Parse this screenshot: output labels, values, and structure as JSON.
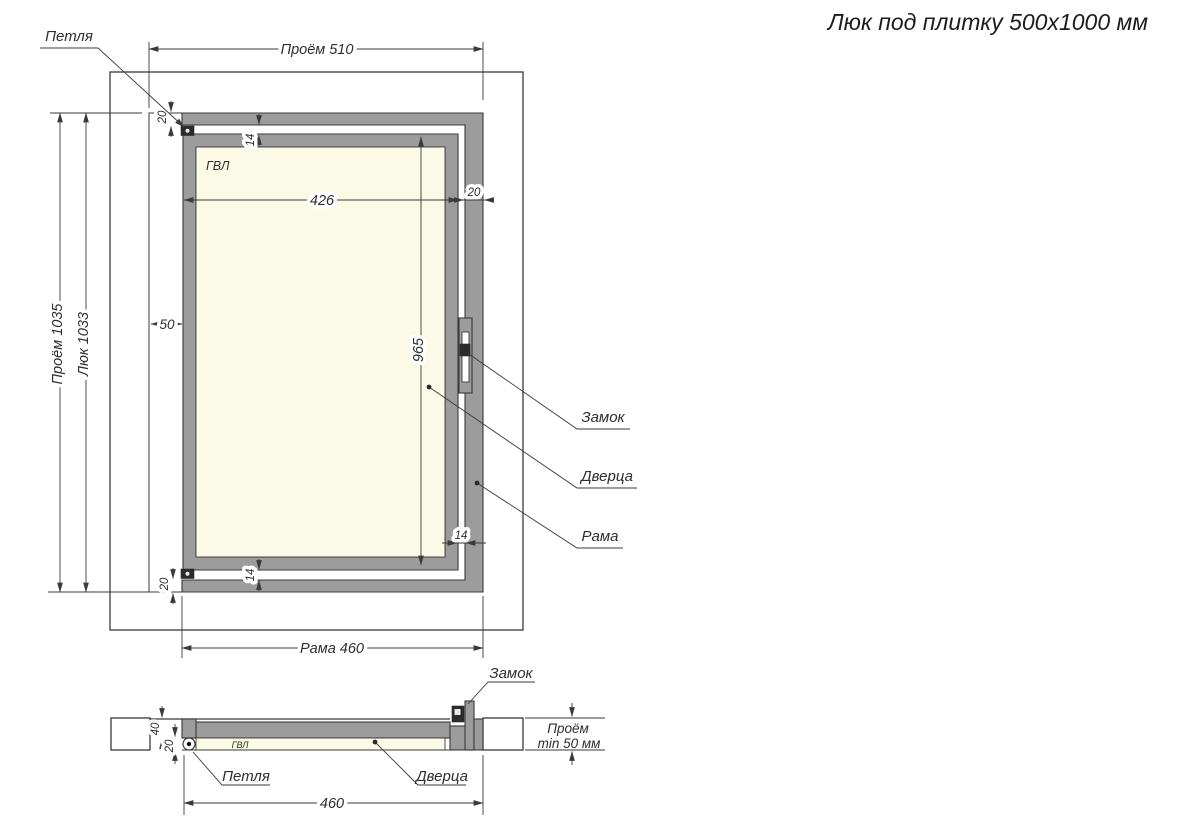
{
  "title": "Люк под плитку 500x1000 мм",
  "colors": {
    "frame_gray": "#9c9c9c",
    "panel_fill": "#fafae6",
    "line": "#3a3a3a"
  },
  "front_view": {
    "dims": {
      "opening_width": "Проём 510",
      "opening_height": "Проём 1035",
      "hatch_height": "Люк 1033",
      "frame_width": "Рама 460",
      "door_width": "426",
      "door_height": "965",
      "side_gap": "50",
      "frame_profile_top_left": "20",
      "frame_profile_right": "20",
      "frame_profile_bottom_left": "20",
      "clearance_top": "14",
      "clearance_bottom": "14",
      "clearance_right": "14"
    },
    "labels": {
      "hinge": "Петля",
      "lock": "Замок",
      "door": "Дверца",
      "frame": "Рама",
      "panel": "ГВЛ"
    }
  },
  "section_view": {
    "dims": {
      "frame_width": "460",
      "frame_depth": "40",
      "panel_thickness": "20",
      "opening_depth_line1": "Проём",
      "opening_depth_line2": "min 50 мм"
    },
    "labels": {
      "lock": "Замок",
      "hinge": "Петля",
      "door": "Дверца",
      "panel": "ГВЛ"
    }
  }
}
